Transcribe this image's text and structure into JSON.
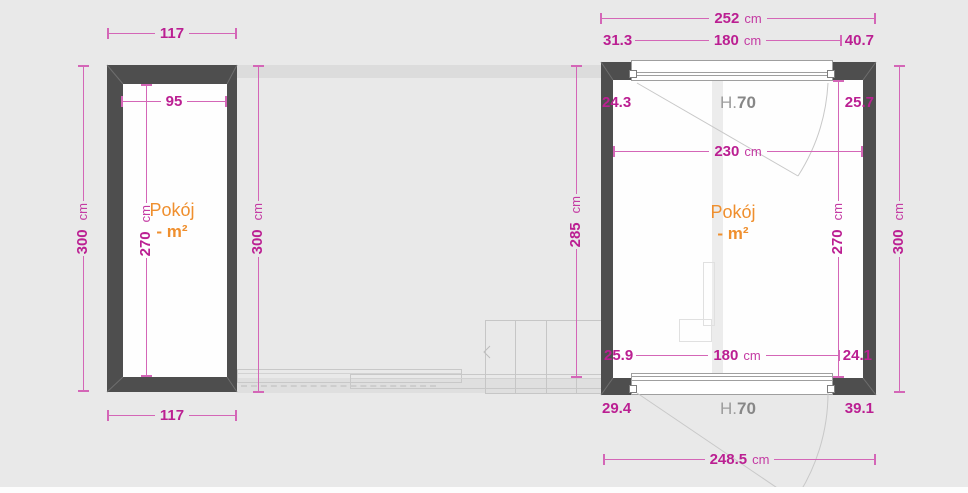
{
  "plan": {
    "colors": {
      "background": "#e9e9e9",
      "wall": "#4e4e4e",
      "dimension_text": "#bb1f92",
      "dimension_line": "#d466b7",
      "room_label": "#ef8f2e",
      "door_height_label": "#9d9d9d"
    },
    "left_room": {
      "name_line1": "Pokój",
      "name_line2": "- m²",
      "top_width": {
        "value": "117"
      },
      "bottom_width": {
        "value": "117"
      },
      "inner_width": {
        "value": "95"
      },
      "inner_height": {
        "value": "270",
        "unit": "cm"
      },
      "outer_height_left": {
        "value": "300",
        "unit": "cm"
      },
      "outer_height_right": {
        "value": "300",
        "unit": "cm"
      }
    },
    "hall": {
      "height": {
        "value": "285",
        "unit": "cm"
      }
    },
    "right_room": {
      "name_line1": "Pokój",
      "name_line2": "- m²",
      "total_width": {
        "value": "252",
        "unit": "cm"
      },
      "top_split": {
        "left": "31.3",
        "center": "180",
        "center_unit": "cm",
        "right": "40.7"
      },
      "top_inner": {
        "left": "24.3",
        "door_prefix": "H.",
        "door_height": "70",
        "right": "25.7"
      },
      "inner_width": {
        "value": "230",
        "unit": "cm"
      },
      "inner_height": {
        "value": "270",
        "unit": "cm"
      },
      "outer_height": {
        "value": "300",
        "unit": "cm"
      },
      "bottom_inner": {
        "left": "25.9",
        "center": "180",
        "center_unit": "cm",
        "right": "24.1"
      },
      "bottom_split": {
        "left": "29.4",
        "door_prefix": "H.",
        "door_height": "70",
        "right": "39.1"
      },
      "total_bottom_width": {
        "value": "248.5",
        "unit": "cm"
      }
    }
  }
}
